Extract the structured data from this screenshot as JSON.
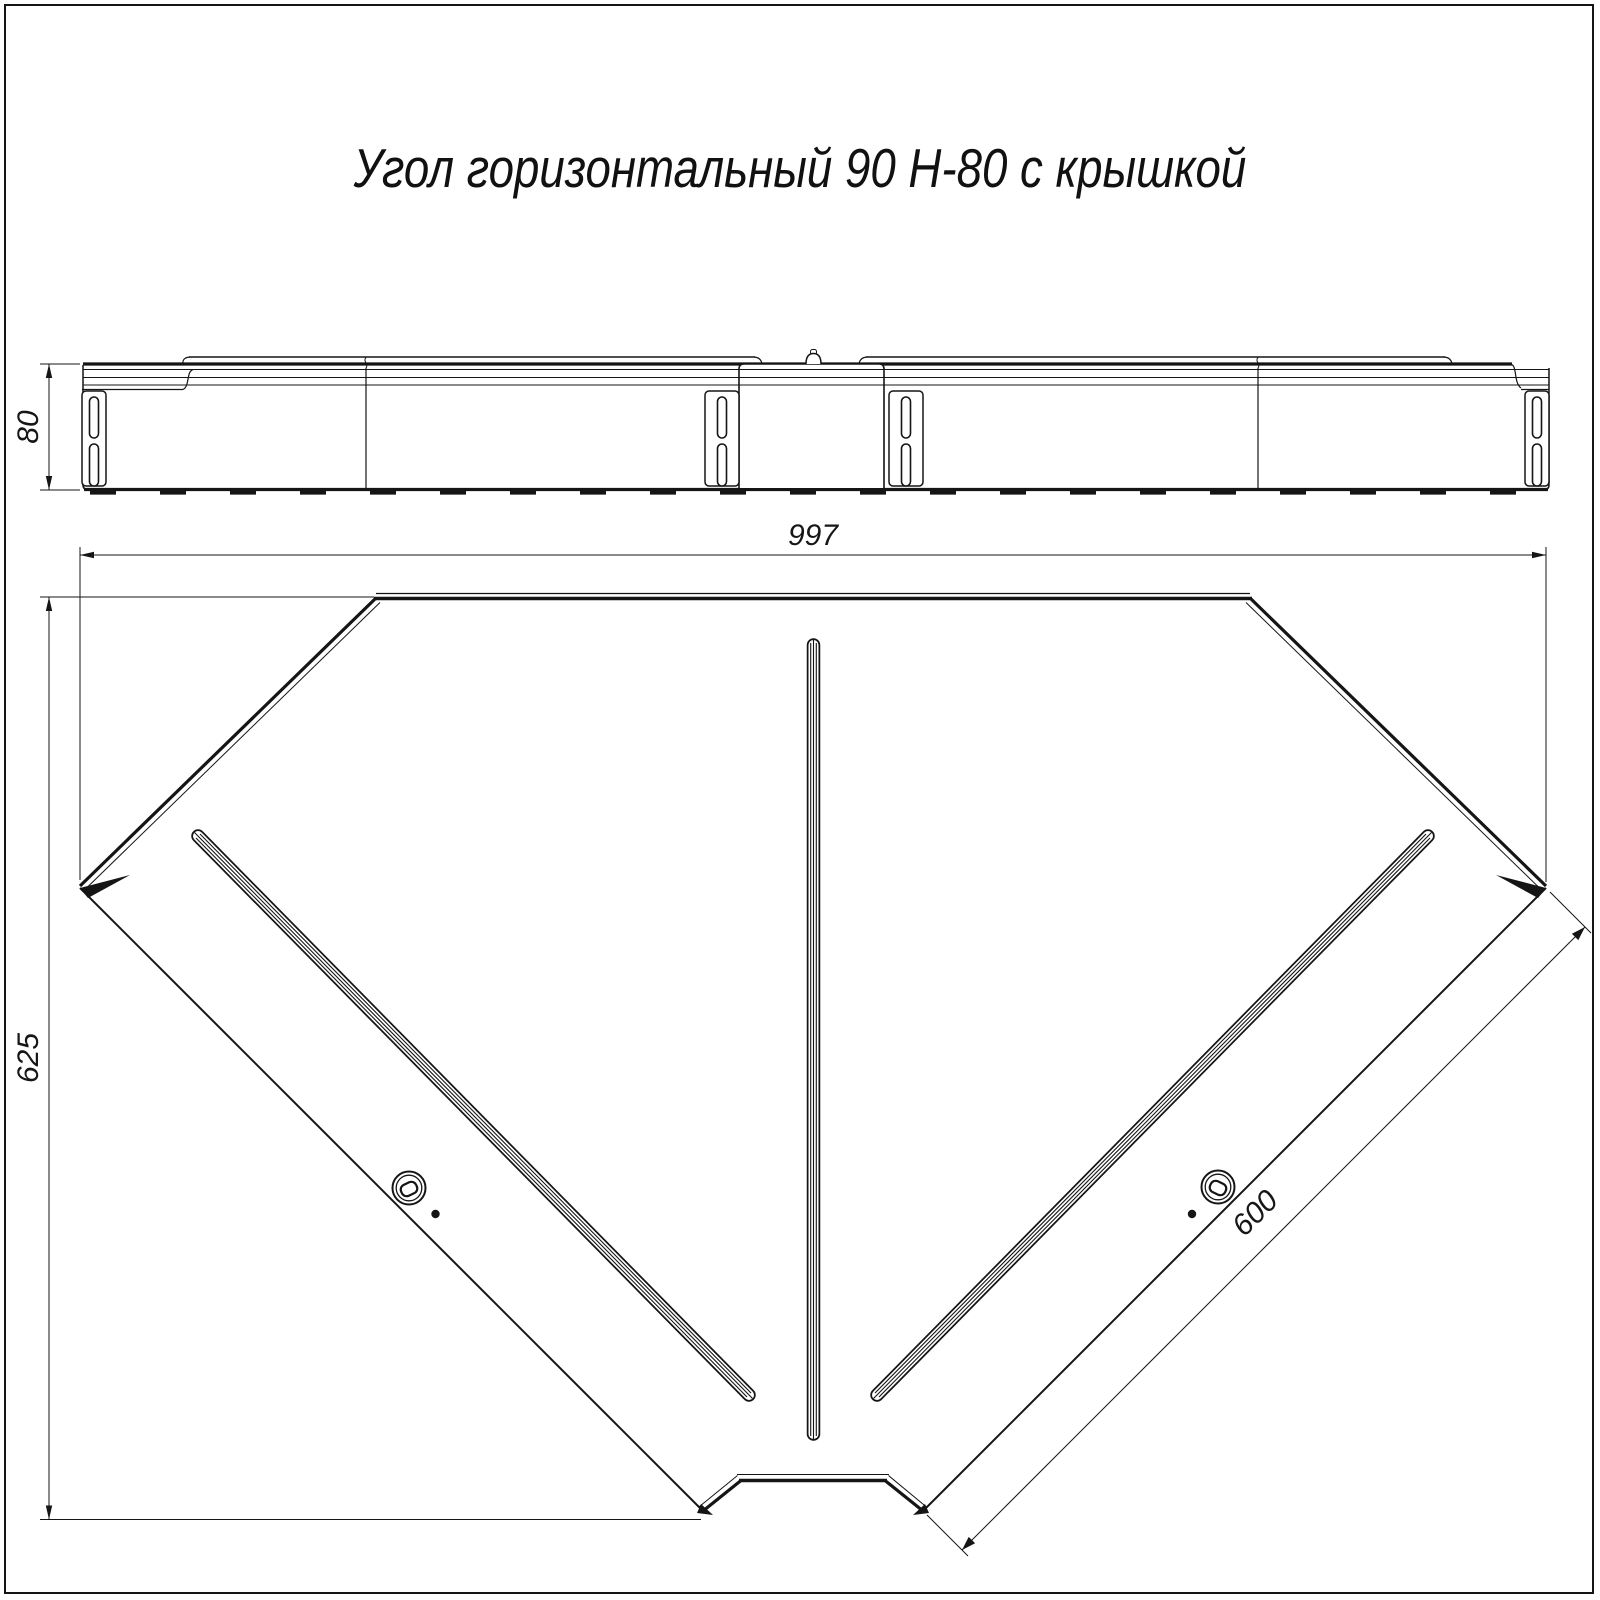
{
  "title": "Угол горизонтальный 90 Н-80 с крышкой",
  "dimensions": {
    "height": "80",
    "overall_width": "997",
    "overall_depth": "625",
    "tray_width": "600"
  }
}
